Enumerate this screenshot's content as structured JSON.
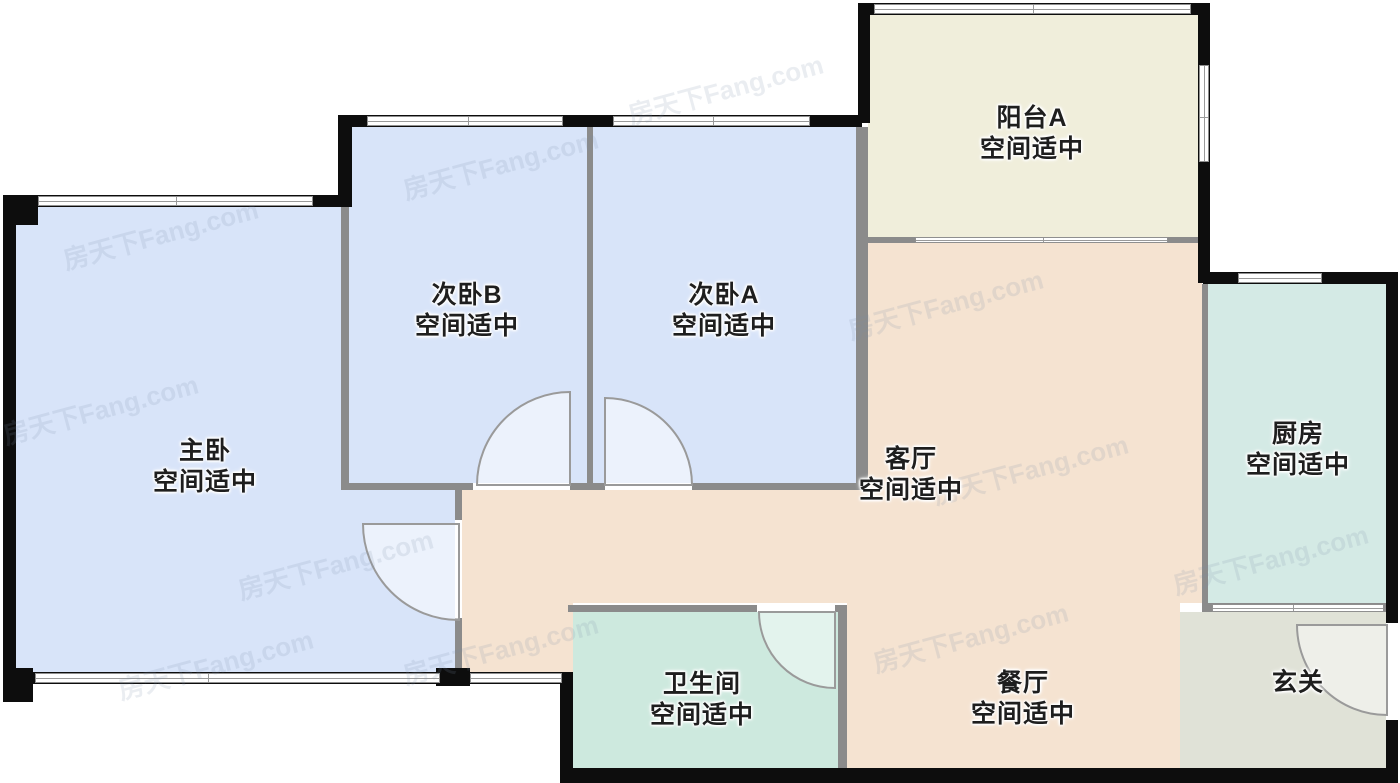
{
  "floorplan": {
    "title": "户型图",
    "watermark": {
      "text": "房天下Fang.com"
    },
    "rooms": {
      "master": {
        "name": "主卧",
        "status": "空间适中",
        "color": "#d8e4f9"
      },
      "bedroomB": {
        "name": "次卧B",
        "status": "空间适中",
        "color": "#d8e4f9"
      },
      "bedroomA": {
        "name": "次卧A",
        "status": "空间适中",
        "color": "#d8e4f9"
      },
      "balconyA": {
        "name": "阳台A",
        "status": "空间适中",
        "color": "#f0eedb"
      },
      "living": {
        "name": "客厅",
        "status": "空间适中",
        "color": "#f5e3d1"
      },
      "kitchen": {
        "name": "厨房",
        "status": "空间适中",
        "color": "#d4eae5"
      },
      "bath": {
        "name": "卫生间",
        "status": "空间适中",
        "color": "#cde9de"
      },
      "dining": {
        "name": "餐厅",
        "status": "空间适中",
        "color": "#f5e3d1"
      },
      "foyer": {
        "name": "玄关",
        "color": "#e0e2d7"
      }
    },
    "colors": {
      "wall": "#0d0d0d",
      "partition": "#8b8b8b",
      "window_frame": "#8f8f8f",
      "door_arc": "#9a9a9a"
    }
  }
}
